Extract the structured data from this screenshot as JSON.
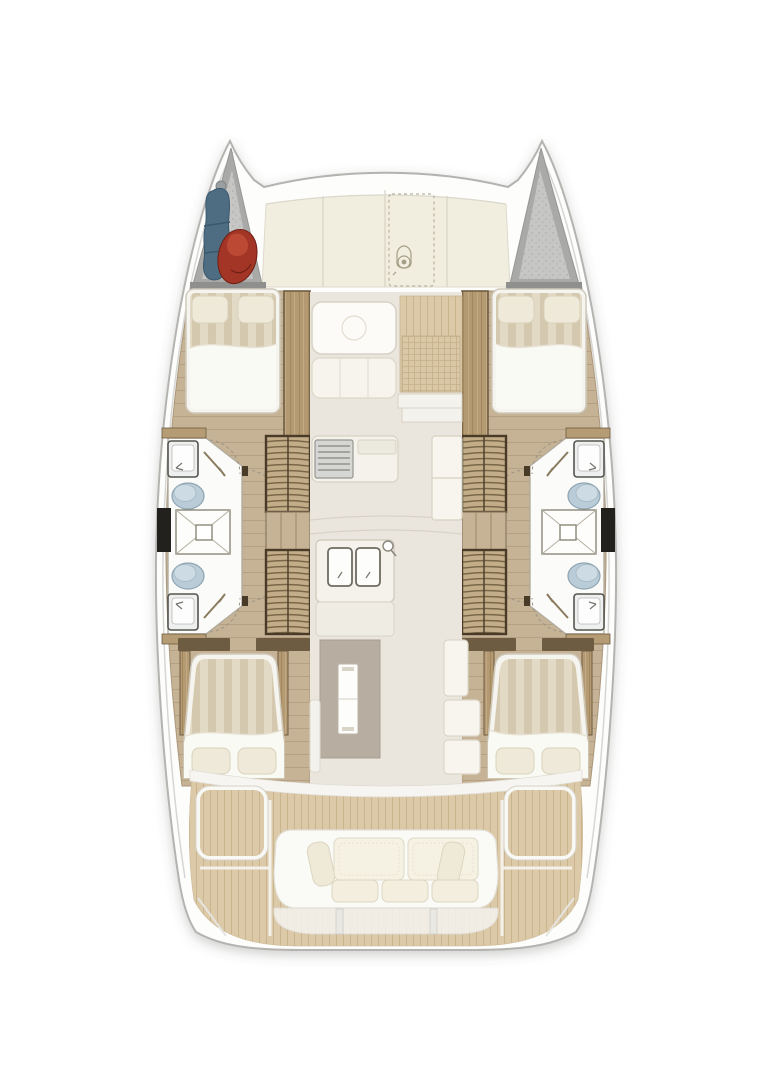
{
  "plan": {
    "type": "catamaran-yacht-floorplan",
    "orientation": "bow-up",
    "hull_count": 2,
    "cabins": [
      {
        "id": "port-forward-cabin",
        "berth": "double",
        "pillows": 2
      },
      {
        "id": "starboard-forward-cabin",
        "berth": "double",
        "pillows": 2
      },
      {
        "id": "port-aft-cabin",
        "berth": "double",
        "pillows": 2
      },
      {
        "id": "starboard-aft-cabin",
        "berth": "double",
        "pillows": 2
      }
    ],
    "bathrooms": [
      {
        "id": "port-forward-head",
        "fixtures": [
          "sink",
          "toilet"
        ]
      },
      {
        "id": "port-aft-head",
        "fixtures": [
          "sink",
          "toilet"
        ]
      },
      {
        "id": "starboard-forward-head",
        "fixtures": [
          "sink",
          "toilet"
        ]
      },
      {
        "id": "starboard-aft-head",
        "fixtures": [
          "sink",
          "toilet"
        ]
      }
    ],
    "showers": 2,
    "galley": {
      "stove": true,
      "double_sink": true,
      "fridge_cabinet": true
    },
    "saloon": {
      "dinette_table": true,
      "bench_seating": true,
      "nav_mat": true,
      "saloon_table_with_leaf": true
    },
    "companionways": 2,
    "cockpit": {
      "sofa_back_cushions": 2,
      "sofa_seat_cushions": 3,
      "side_bolsters": 2,
      "deck": "teak",
      "deck_hatches": 2
    },
    "bow": {
      "port_locker_contents": [
        "sail-bag",
        "fender"
      ],
      "starboard_locker_contents": []
    },
    "foredeck": {
      "panels": 4,
      "dashed_outline_locker": true,
      "windlass_symbol": true
    }
  },
  "colors": {
    "background": "#ffffff",
    "hull_white": "#fdfdfc",
    "hull_outline": "#b5b3b0",
    "deck_cream": "#f1eee0",
    "saloon_floor": "#eae6dd",
    "teak": "#dcc9a8",
    "teak_line": "#c9b48e",
    "plank_tan": "#c6b294",
    "wood_mid": "#a98f68",
    "wood_dark": "#6e5c42",
    "step_frame": "#4a3a28",
    "mattress_base": "#e3dac6",
    "mattress_stripe": "#d4c8ae",
    "bed_linen": "#f6f4ee",
    "pillow_cream": "#efe9d9",
    "toilet_blue": "#b9ccd8",
    "toilet_rim": "#8fa5b3",
    "locker_gray": "#a9a9a7",
    "locker_inner": "#c6c6c4",
    "dark_locker": "#23211e",
    "fender_red": "#a23526",
    "sailbag_blue": "#4e6d83",
    "table_taupe": "#b7aea1",
    "sofa_white": "#fafaf7",
    "cushion_cream": "#f3eedd"
  }
}
